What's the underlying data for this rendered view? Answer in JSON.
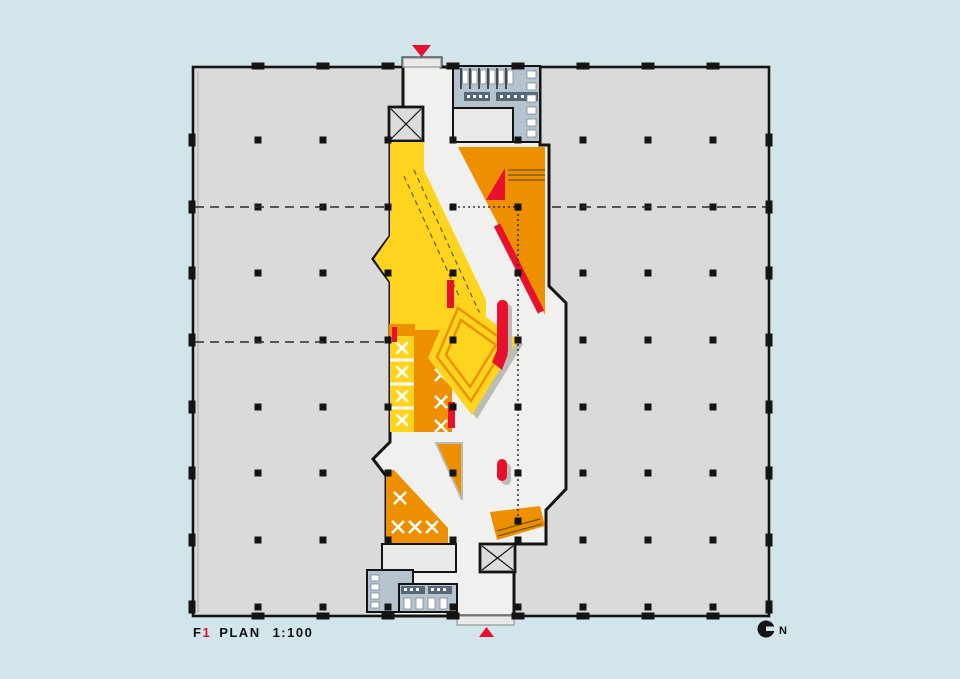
{
  "plan": {
    "title": {
      "floor_letter": "F",
      "floor_number": "1",
      "word": "PLAN",
      "scale": "1:100"
    },
    "north_label": "N"
  },
  "colors": {
    "bg": "#d2e5eb",
    "plate": "#dadada",
    "spine": "#f0f0ee",
    "yellow": "#ffd41e",
    "orange": "#ee8f00",
    "red": "#e8112d",
    "bluegray": "#b5c3cf",
    "bluegray_dark": "#566876",
    "room": "#e9e9e7",
    "shaft": "#dcdcda",
    "shadow": "#bcbcb6",
    "detail_line": "#6b5500",
    "ink": "#141414",
    "text": "#111111"
  },
  "grid": {
    "plate": {
      "x": 193,
      "y": 67,
      "w": 576,
      "h": 549
    },
    "cols": [
      258,
      323,
      388,
      453,
      518,
      583,
      648,
      713
    ],
    "rows": [
      140,
      207,
      273,
      340,
      407,
      473,
      540,
      607
    ],
    "square": 7,
    "tick": {
      "w": 13,
      "h": 7
    },
    "extra_squares": [
      [
        518,
        521
      ]
    ],
    "dashed": [
      [
        195,
        207,
        387,
        207
      ],
      [
        552,
        207,
        766,
        207
      ],
      [
        195,
        342,
        385,
        342
      ]
    ],
    "dotted": [
      [
        453,
        207,
        517,
        207
      ],
      [
        518,
        209,
        518,
        521
      ]
    ]
  }
}
